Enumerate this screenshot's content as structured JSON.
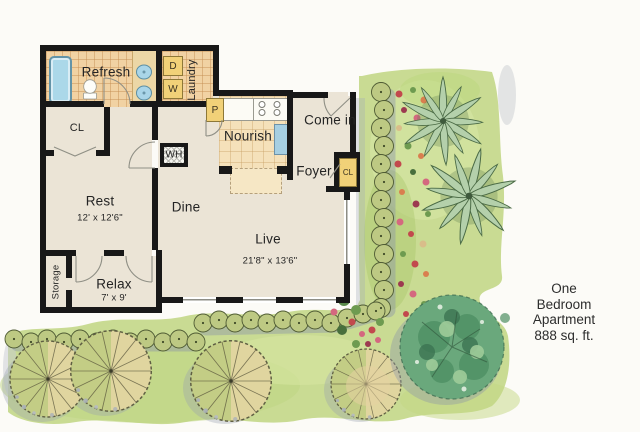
{
  "title": {
    "line1": "One Bedroom Apartment",
    "line2": "888 sq. ft."
  },
  "rooms": {
    "refresh": {
      "label": "Refresh"
    },
    "laundry": {
      "label": "Laundry",
      "dryer": "D",
      "washer": "W"
    },
    "pantry": {
      "label": "P"
    },
    "bedroom_closet": {
      "label": "CL"
    },
    "rest": {
      "label": "Rest",
      "dims": "12' x 12'6\""
    },
    "water_heater": {
      "label": "WH"
    },
    "dine": {
      "label": "Dine"
    },
    "nourish": {
      "label": "Nourish"
    },
    "come_in": {
      "label": "Come in"
    },
    "foyer": {
      "label": "Foyer"
    },
    "foyer_closet": {
      "label": "CL"
    },
    "live": {
      "label": "Live",
      "dims": "21'8\" x 13'6\""
    },
    "relax": {
      "label": "Relax",
      "dims": "7' x 9'"
    },
    "storage": {
      "label": "Storage"
    }
  },
  "colors": {
    "wall": "#181818",
    "floor": "#ebe4d6",
    "bath_tile": "#f1d2a3",
    "kitchen_tile": "#f5e1ba",
    "fixture_blue": "#abd8e9",
    "cabinet_yellow": "#f1d178",
    "grass": "#c9db93",
    "hedge": "#bdc983",
    "palm": "#b4d0ab",
    "tree_dark": "#6aa87c",
    "tree_light": "#c3cd85",
    "text": "#2d2d2d"
  }
}
